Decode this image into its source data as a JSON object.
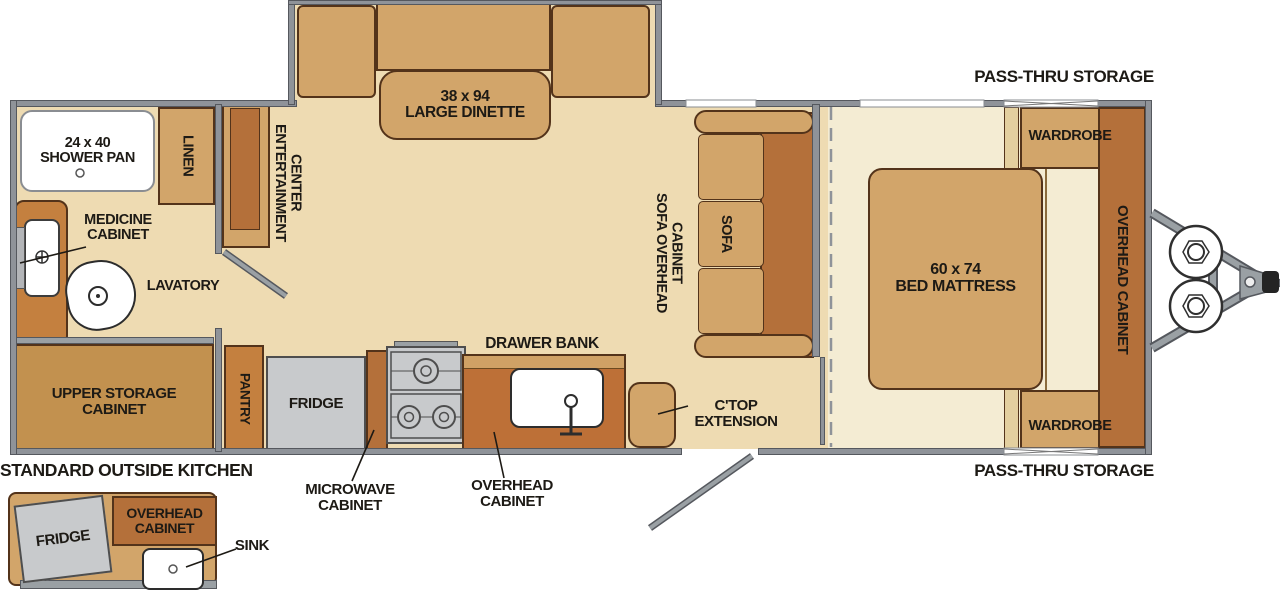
{
  "plan": {
    "exterior": {
      "pass_thru_storage_top": "PASS-THRU STORAGE",
      "pass_thru_storage_bottom": "PASS-THRU STORAGE"
    },
    "bathroom": {
      "shower_size": "24 x 40",
      "shower_name": "SHOWER PAN",
      "linen": "LINEN",
      "medicine_line1": "MEDICINE",
      "medicine_line2": "CABINET",
      "lavatory": "LAVATORY"
    },
    "living": {
      "entertainment_line1": "ENTERTAINMENT",
      "entertainment_line2": "CENTER",
      "dinette_size": "38 x 94",
      "dinette_name": "LARGE DINETTE",
      "sofa_overhead_line1": "SOFA OVERHEAD",
      "sofa_overhead_line2": "CABINET",
      "sofa": "SOFA"
    },
    "kitchen": {
      "upper_storage_line1": "UPPER STORAGE",
      "upper_storage_line2": "CABINET",
      "pantry": "PANTRY",
      "fridge": "FRIDGE",
      "drawer_bank": "DRAWER BANK",
      "microwave_line1": "MICROWAVE",
      "microwave_line2": "CABINET",
      "overhead_line1": "OVERHEAD",
      "overhead_line2": "CABINET",
      "ctop_line1": "C'TOP",
      "ctop_line2": "EXTENSION"
    },
    "bedroom": {
      "bed_size": "60 x 74",
      "bed_name": "BED MATTRESS",
      "wardrobe_top": "WARDROBE",
      "wardrobe_bottom": "WARDROBE",
      "overhead_cabinet": "OVERHEAD CABINET"
    },
    "outside_kitchen": {
      "title": "STANDARD OUTSIDE KITCHEN",
      "fridge": "FRIDGE",
      "overhead_line1": "OVERHEAD",
      "overhead_line2": "CABINET",
      "sink": "SINK"
    },
    "colors": {
      "floor": "#eedbb2",
      "floor_bedroom": "#f4ecd3",
      "wall_gray": "#8f9399",
      "cabinet_tan": "#d2a56a",
      "cabinet_dark": "#b4703a",
      "cabinet_medium": "#c4803f",
      "storage_brown": "#c2914f",
      "appliance_gray": "#c8cacc",
      "counter_dark": "#bd7037",
      "text": "#1d1a15"
    }
  }
}
